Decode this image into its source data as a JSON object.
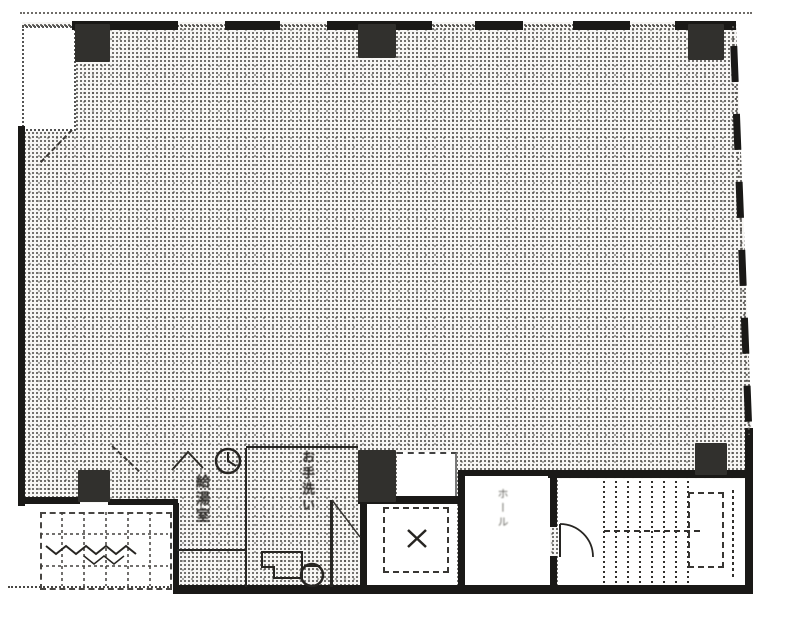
{
  "plan": {
    "rooms": {
      "kitchenette": {
        "label": "給湯室"
      },
      "toilet": {
        "label": "お手洗い"
      },
      "elevator_hall": {
        "label": "ホール"
      }
    },
    "colors": {
      "ink": "#1d1c1a",
      "halftone_dot": "#2d2b28",
      "paper": "#fdfdfc"
    }
  }
}
